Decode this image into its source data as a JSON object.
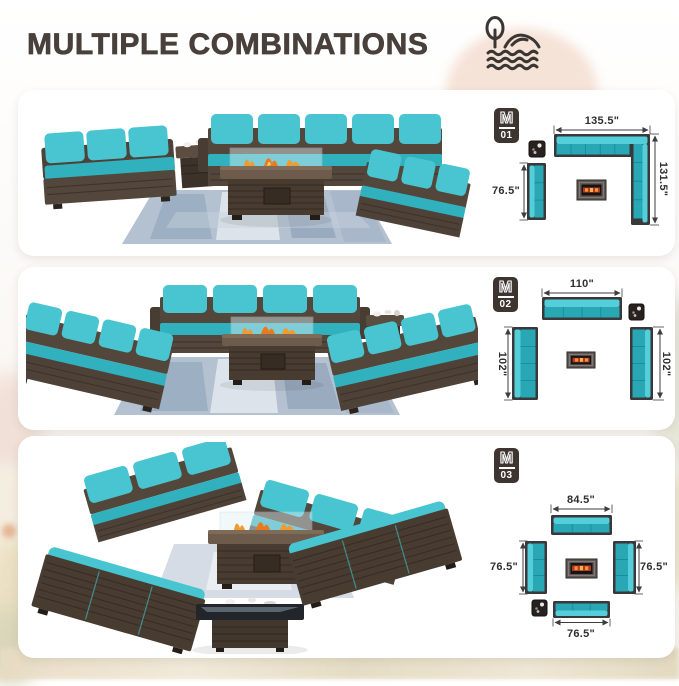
{
  "header": {
    "title": "MULTIPLE COMBINATIONS",
    "icon": "beach-island-icon"
  },
  "colors": {
    "accent_teal": "#48c5d0",
    "diagram_teal": "#2aa7b5",
    "wicker_brown": "#53463b",
    "badge_background": "#3e3530",
    "title_text": "#49403b",
    "dimension_text": "#2f2f2f",
    "card_background": "#ffffff",
    "flame_orange": "#f2992f"
  },
  "panels": [
    {
      "badge": {
        "letter": "M",
        "number": "01"
      },
      "measurements": {
        "top": "135.5\"",
        "right": "131.5\"",
        "left": "76.5\""
      },
      "diagram_icons": [
        "side-table-top-icon",
        "fire-pit-top-icon"
      ]
    },
    {
      "badge": {
        "letter": "M",
        "number": "02"
      },
      "measurements": {
        "top": "110\"",
        "left": "102\"",
        "right": "102\""
      },
      "diagram_icons": [
        "side-table-top-icon",
        "fire-pit-top-icon"
      ]
    },
    {
      "badge": {
        "letter": "M",
        "number": "03"
      },
      "measurements": {
        "top": "84.5\"",
        "left": "76.5\"",
        "right": "76.5\"",
        "bottom": "76.5\""
      },
      "diagram_icons": [
        "side-table-top-icon",
        "fire-pit-top-icon"
      ]
    }
  ]
}
